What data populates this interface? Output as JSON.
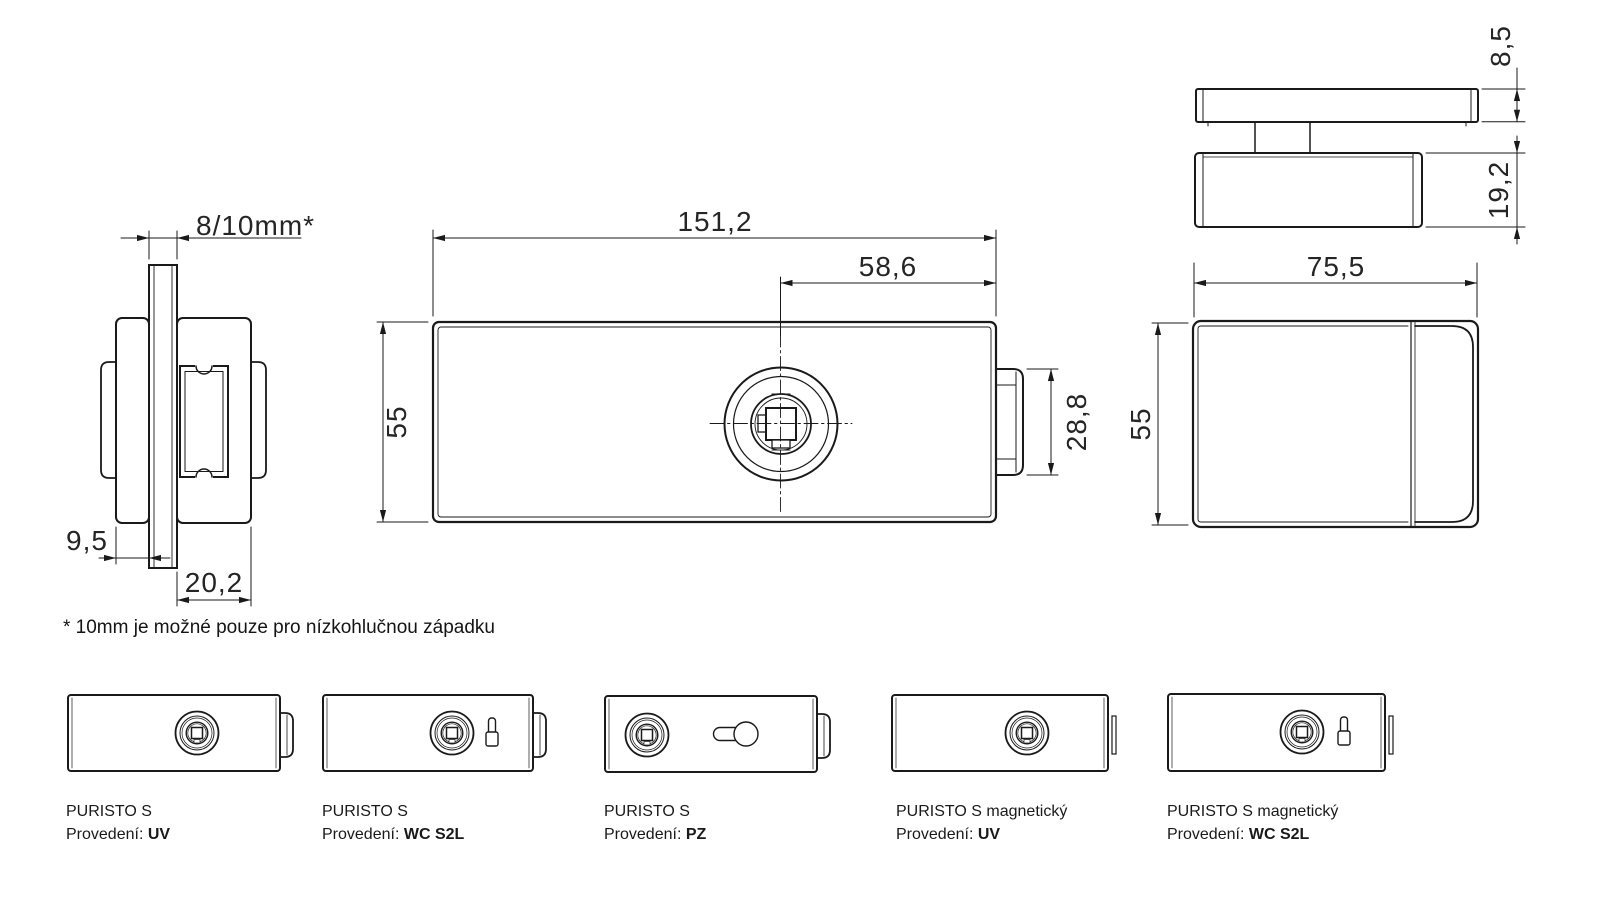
{
  "dimensions": {
    "side_view": {
      "glass_thickness": "8/10mm*",
      "inner_offset": "9,5",
      "body_depth": "20,2"
    },
    "front_view": {
      "width": "151,2",
      "spindle_offset": "58,6",
      "height": "55",
      "latch_height": "28,8"
    },
    "top_view": {
      "cover_thickness": "8,5",
      "body_thickness": "19,2",
      "width": "75,5"
    },
    "end_view": {
      "height": "55"
    }
  },
  "footnote": "* 10mm je možné pouze pro nízkohlučnou západku",
  "variants": [
    {
      "name": "PURISTO S",
      "prefix": "Provedení:",
      "value": "UV"
    },
    {
      "name": "PURISTO S",
      "prefix": "Provedení:",
      "value": "WC S2L"
    },
    {
      "name": "PURISTO S",
      "prefix": "Provedení:",
      "value": "PZ"
    },
    {
      "name": "PURISTO S magnetický",
      "prefix": "Provedení:",
      "value": "UV"
    },
    {
      "name": "PURISTO S magnetický",
      "prefix": "Provedení:",
      "value": "WC S2L"
    }
  ],
  "colors": {
    "line": "#1a1a1a",
    "text": "#252525",
    "background": "#ffffff"
  }
}
